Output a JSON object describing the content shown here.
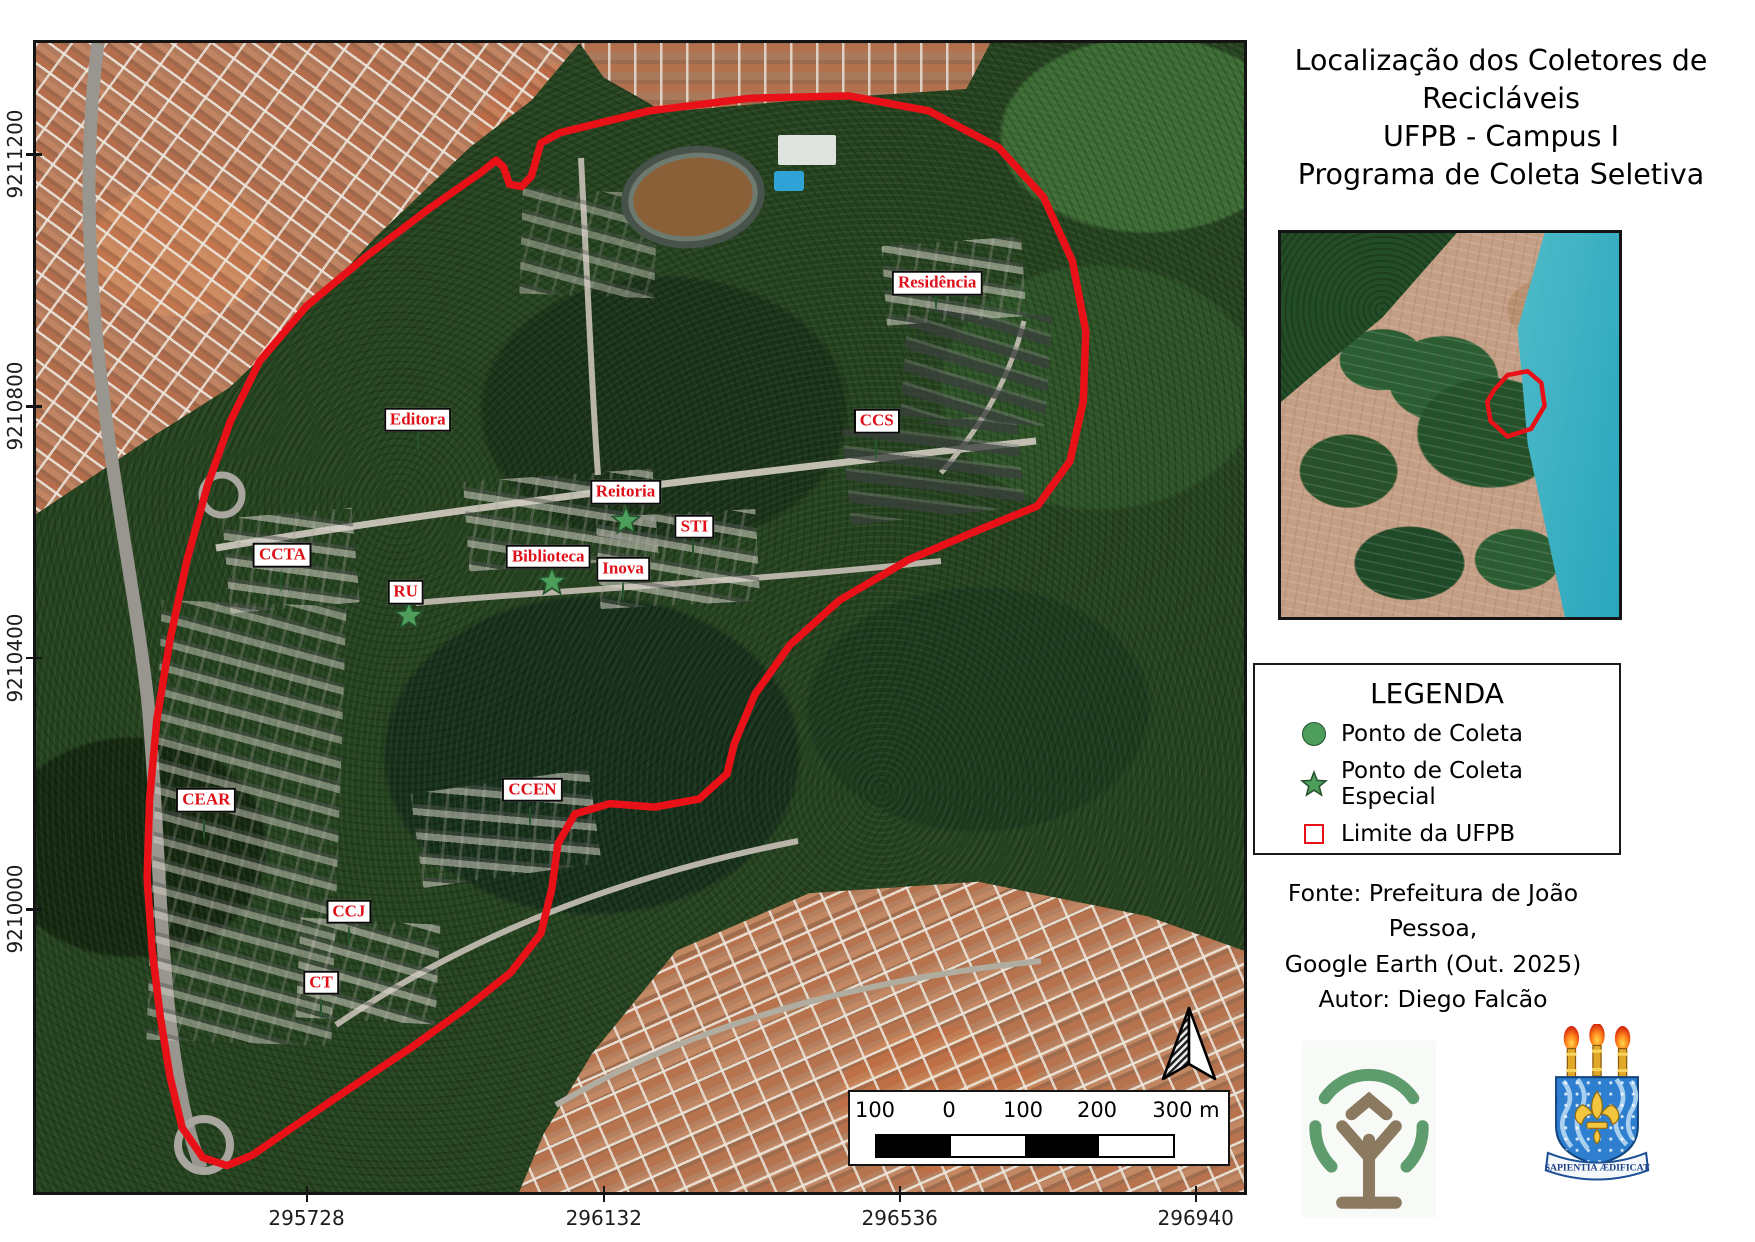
{
  "title": {
    "line1": "Localização dos Coletores de Recicláveis",
    "line2": "UFPB - Campus I",
    "line3": "Programa de Coleta Seletiva"
  },
  "legend": {
    "heading": "LEGENDA",
    "items": [
      {
        "symbol": "circle",
        "label": "Ponto de Coleta"
      },
      {
        "symbol": "star",
        "label": "Ponto de Coleta Especial"
      },
      {
        "symbol": "boundary",
        "label": "Limite da UFPB"
      }
    ]
  },
  "source": {
    "line1": "Fonte: Prefeitura de João Pessoa,",
    "line2": "Google Earth (Out. 2025)",
    "line3": "Autor: Diego Falcão"
  },
  "crest_motto": "SAPIENTIA ÆDIFICAT",
  "map": {
    "x_ticks": [
      {
        "label": "295728",
        "pos": 22.4
      },
      {
        "label": "296132",
        "pos": 47.0
      },
      {
        "label": "296536",
        "pos": 71.5
      },
      {
        "label": "296940",
        "pos": 96.0
      }
    ],
    "y_ticks": [
      {
        "label": "9211200",
        "pos": 9.7
      },
      {
        "label": "9210800",
        "pos": 31.6
      },
      {
        "label": "9210400",
        "pos": 53.5
      },
      {
        "label": "9210000",
        "pos": 75.4
      }
    ],
    "scalebar": {
      "labels": [
        "100",
        "0",
        "100",
        "200",
        "300 m"
      ],
      "segments": 4
    },
    "points": [
      {
        "name": "Residência",
        "type": "circle",
        "marker": {
          "x": 74.5,
          "y": 22.4
        },
        "label": {
          "x": 74.6,
          "y": 20.9
        }
      },
      {
        "name": "Editora",
        "type": "circle",
        "marker": {
          "x": 31.6,
          "y": 34.6
        },
        "label": {
          "x": 31.6,
          "y": 32.8
        }
      },
      {
        "name": "CCS",
        "type": "circle",
        "marker": {
          "x": 69.5,
          "y": 35.3
        },
        "label": {
          "x": 69.6,
          "y": 32.9
        }
      },
      {
        "name": "Reitoria",
        "type": "star",
        "marker": {
          "x": 48.8,
          "y": 41.5
        },
        "label": {
          "x": 48.8,
          "y": 39.1
        }
      },
      {
        "name": "STI",
        "type": "circle",
        "marker": {
          "x": 54.4,
          "y": 44.0
        },
        "label": {
          "x": 54.5,
          "y": 42.1
        }
      },
      {
        "name": "CCTA",
        "type": "circle",
        "marker": {
          "x": 20.3,
          "y": 46.8
        },
        "label": {
          "x": 20.4,
          "y": 44.6
        }
      },
      {
        "name": "Biblioteca",
        "type": "star",
        "marker": {
          "x": 42.7,
          "y": 46.8
        },
        "label": {
          "x": 42.4,
          "y": 44.7
        }
      },
      {
        "name": "Inova",
        "type": "circle",
        "marker": {
          "x": 48.6,
          "y": 47.7
        },
        "label": {
          "x": 48.6,
          "y": 45.8
        }
      },
      {
        "name": "RU",
        "type": "star",
        "marker": {
          "x": 30.9,
          "y": 49.8
        },
        "label": {
          "x": 30.6,
          "y": 47.8
        }
      },
      {
        "name": "CEAR",
        "type": "circle",
        "marker": {
          "x": 13.9,
          "y": 68.4
        },
        "label": {
          "x": 14.1,
          "y": 65.9
        }
      },
      {
        "name": "CCEN",
        "type": "circle",
        "marker": {
          "x": 40.9,
          "y": 67.3
        },
        "label": {
          "x": 41.1,
          "y": 65.0
        }
      },
      {
        "name": "CCJ",
        "type": "circle",
        "marker": {
          "x": 25.9,
          "y": 77.7
        },
        "label": {
          "x": 25.9,
          "y": 75.6
        }
      },
      {
        "name": "CT",
        "type": "circle",
        "marker": {
          "x": 23.6,
          "y": 84.0
        },
        "label": {
          "x": 23.6,
          "y": 81.8
        }
      }
    ],
    "boundary": [
      [
        38.1,
        10.2
      ],
      [
        36.8,
        11.3
      ],
      [
        32.7,
        14.3
      ],
      [
        27.3,
        18.6
      ],
      [
        22.4,
        22.9
      ],
      [
        18.5,
        27.7
      ],
      [
        16.1,
        32.9
      ],
      [
        14.2,
        38.5
      ],
      [
        12.5,
        45.0
      ],
      [
        11.1,
        51.9
      ],
      [
        10.0,
        58.9
      ],
      [
        9.4,
        65.8
      ],
      [
        9.2,
        72.7
      ],
      [
        9.6,
        78.8
      ],
      [
        10.3,
        84.8
      ],
      [
        11.1,
        90.0
      ],
      [
        12.1,
        94.4
      ],
      [
        13.8,
        97.0
      ],
      [
        15.8,
        97.7
      ],
      [
        17.9,
        96.8
      ],
      [
        21.2,
        94.4
      ],
      [
        26.1,
        90.9
      ],
      [
        31.1,
        87.4
      ],
      [
        35.6,
        84.0
      ],
      [
        39.3,
        80.9
      ],
      [
        41.8,
        77.5
      ],
      [
        42.7,
        73.6
      ],
      [
        43.2,
        69.7
      ],
      [
        44.6,
        67.1
      ],
      [
        47.5,
        66.2
      ],
      [
        51.2,
        66.5
      ],
      [
        54.9,
        65.8
      ],
      [
        57.2,
        63.6
      ],
      [
        57.8,
        61.0
      ],
      [
        59.5,
        56.7
      ],
      [
        62.4,
        52.4
      ],
      [
        66.5,
        48.5
      ],
      [
        72.2,
        45.0
      ],
      [
        78.0,
        42.4
      ],
      [
        82.9,
        40.3
      ],
      [
        85.6,
        36.4
      ],
      [
        86.7,
        31.2
      ],
      [
        86.9,
        25.1
      ],
      [
        85.8,
        19.0
      ],
      [
        83.4,
        13.4
      ],
      [
        79.7,
        9.1
      ],
      [
        73.9,
        5.9
      ],
      [
        67.3,
        4.6
      ],
      [
        59.1,
        4.8
      ],
      [
        50.8,
        5.9
      ],
      [
        43.4,
        7.8
      ],
      [
        41.8,
        8.7
      ],
      [
        41.0,
        11.6
      ],
      [
        40.2,
        12.5
      ],
      [
        39.2,
        12.3
      ],
      [
        38.7,
        10.8
      ]
    ]
  },
  "inset": {
    "outline": [
      [
        63,
        41
      ],
      [
        67,
        37
      ],
      [
        73,
        36
      ],
      [
        77,
        39
      ],
      [
        78,
        45
      ],
      [
        74,
        51
      ],
      [
        67,
        53
      ],
      [
        62,
        49
      ],
      [
        61,
        44
      ]
    ]
  },
  "colors": {
    "marker_green": "#4d9e5a",
    "marker_border": "#24512c",
    "label_red": "#e01019",
    "boundary_red": "#e91118",
    "water_teal": "#49bccb"
  }
}
